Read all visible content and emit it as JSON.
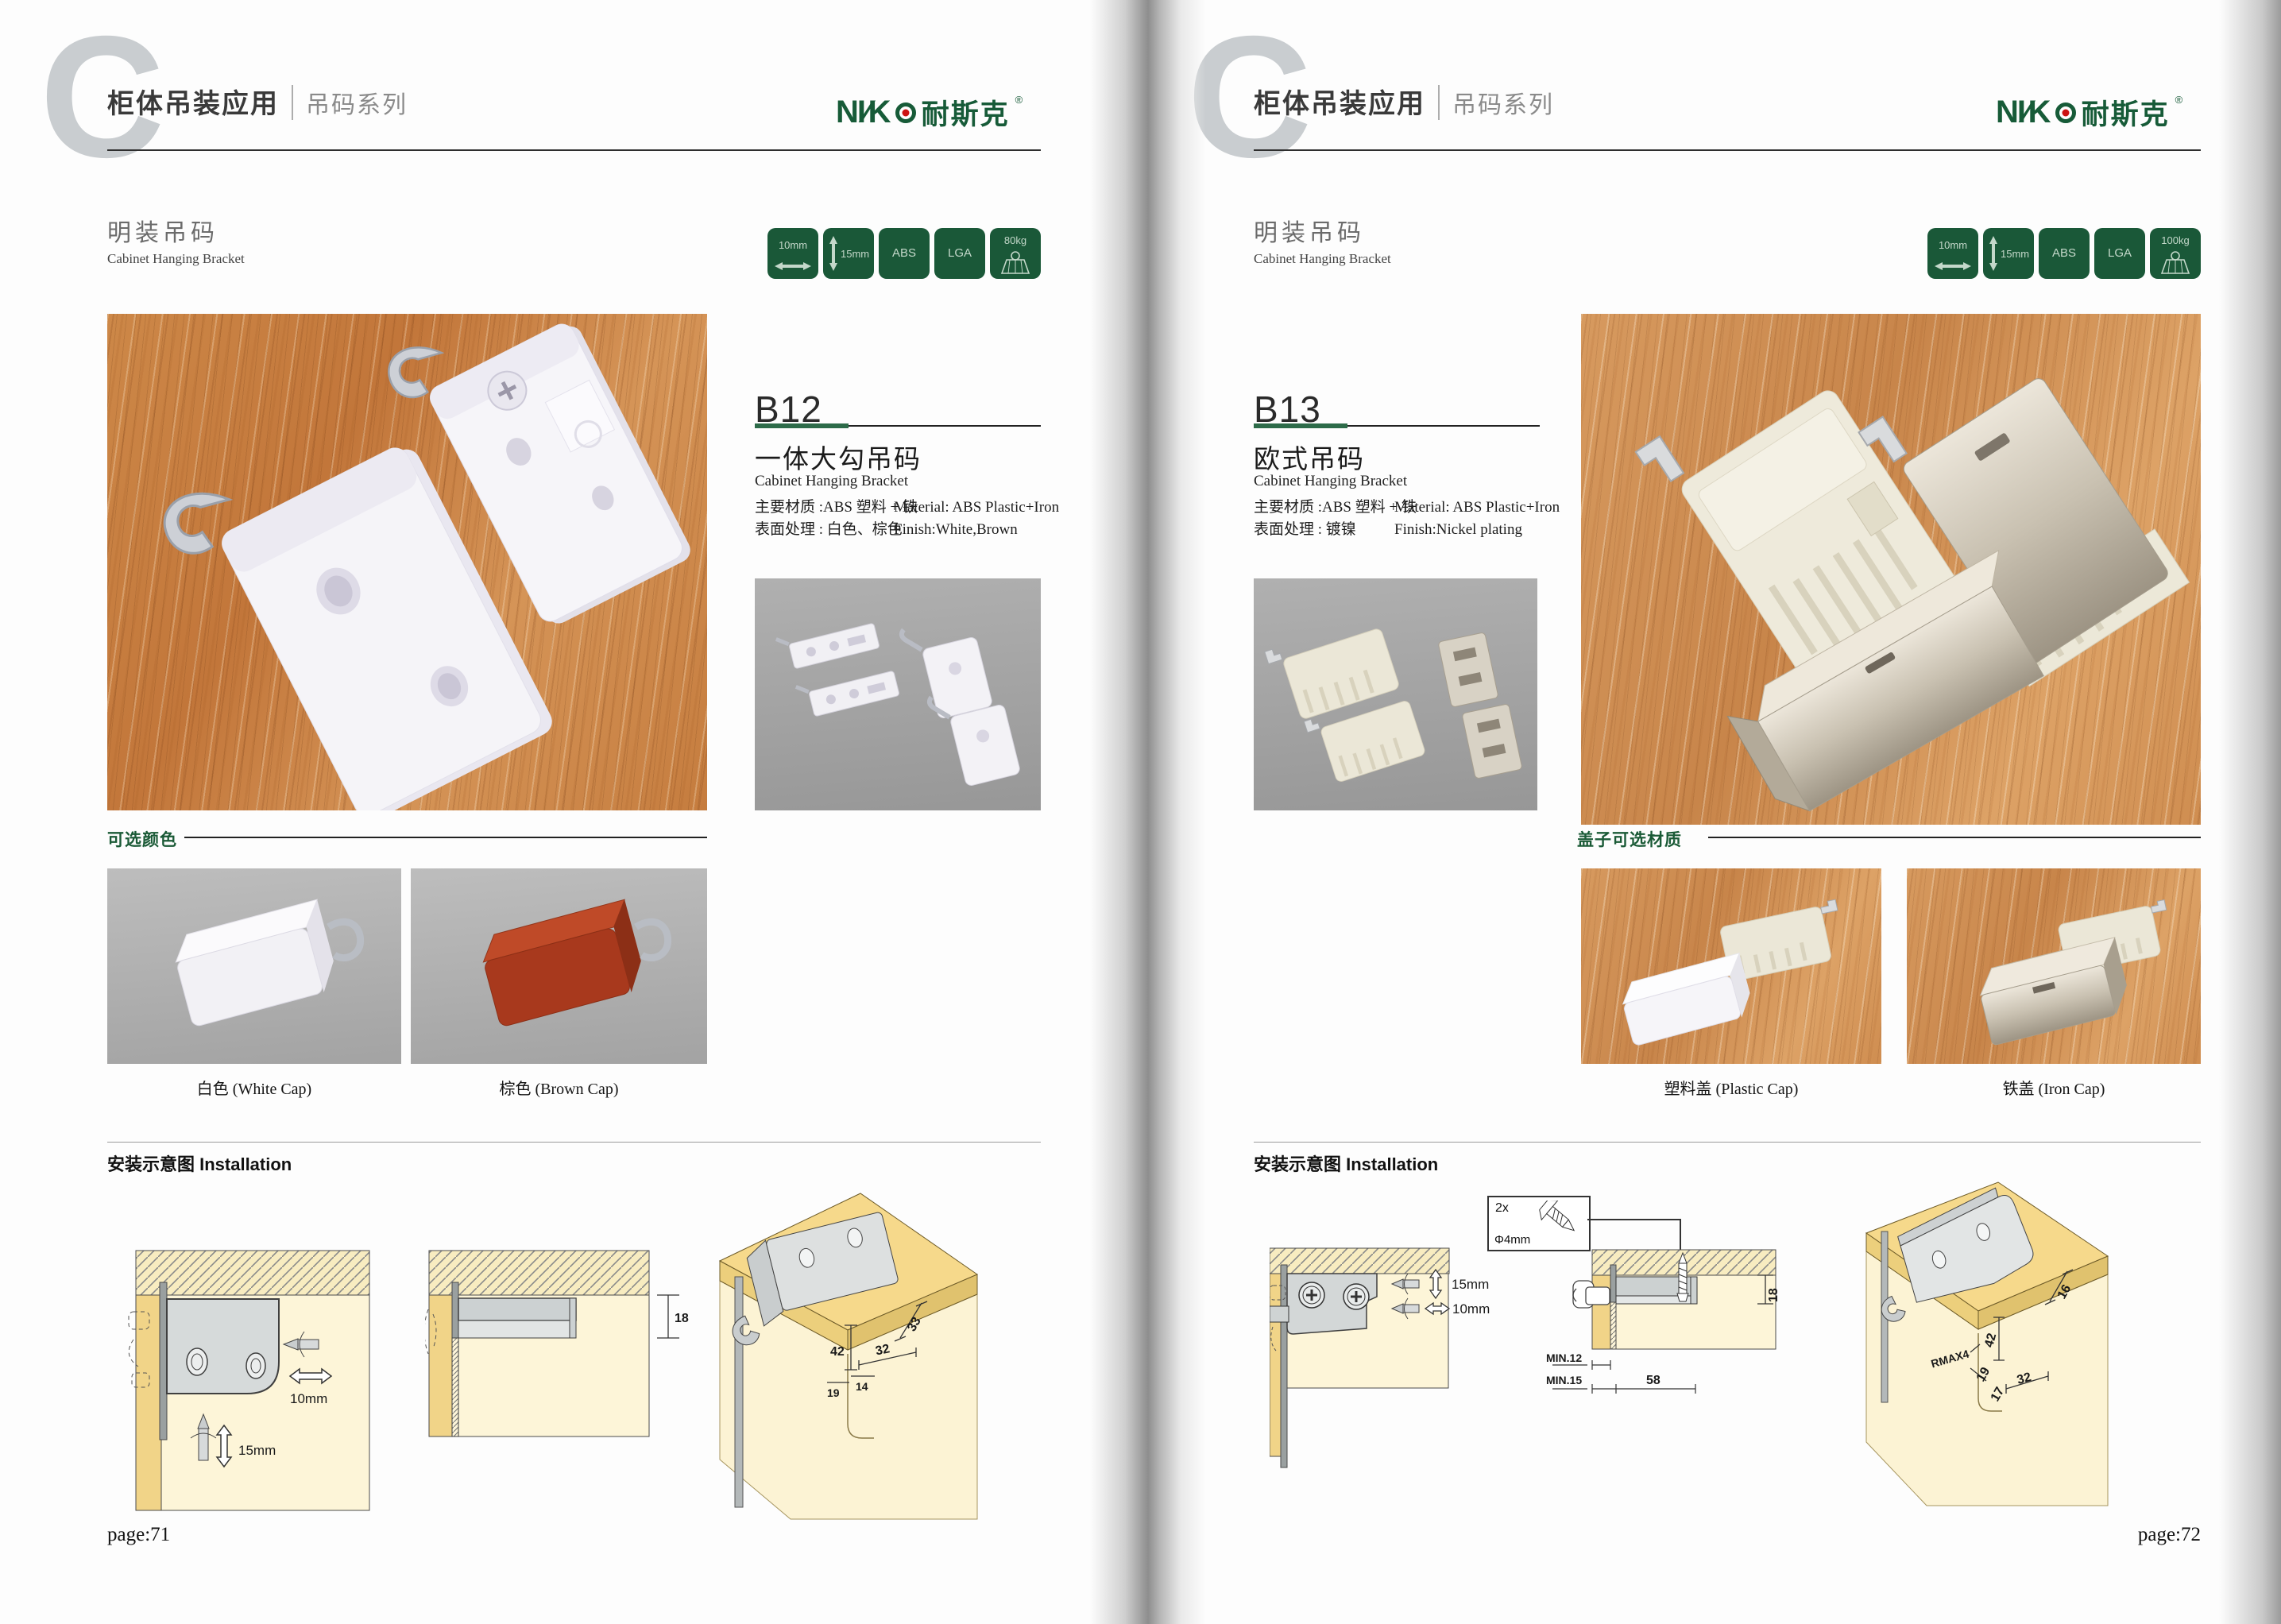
{
  "brand": {
    "logo_latin": "NI∕K",
    "logo_cn": "耐斯克",
    "logo_reg": "®"
  },
  "colors": {
    "brand_green": "#175b38",
    "badge_green": "#1a5838",
    "logo_red": "#cc1212"
  },
  "left": {
    "letter": "C",
    "header": {
      "title": "柜体吊装应用",
      "series": "吊码系列"
    },
    "section": {
      "title_cn": "明装吊码",
      "title_en": "Cabinet Hanging Bracket"
    },
    "badges": [
      {
        "label": "10mm",
        "icon": "width-arrow"
      },
      {
        "label": "15mm",
        "icon": "height-arrow"
      },
      {
        "label": "ABS",
        "icon": "none"
      },
      {
        "label": "LGA",
        "icon": "none"
      },
      {
        "label": "80kg",
        "icon": "load-capacity"
      }
    ],
    "product": {
      "code": "B12",
      "name_cn": "一体大勾吊码",
      "name_en": "Cabinet Hanging Bracket",
      "material_cn": "主要材质 :ABS 塑料 + 铁",
      "material_en": "Material: ABS Plastic+Iron",
      "finish_cn": "表面处理 : 白色、棕色",
      "finish_en": "Finish:White,Brown"
    },
    "options": {
      "title": "可选颜色",
      "captions": [
        "白色 (White Cap)",
        "棕色 (Brown Cap)"
      ]
    },
    "install": {
      "title": "安装示意图 Installation",
      "labels": {
        "d10": "10mm",
        "d15": "15mm",
        "d18": "18",
        "d33": "33",
        "d42": "42",
        "d32": "32",
        "d14": "14",
        "d19": "19"
      }
    },
    "page_label": "page:71"
  },
  "right": {
    "letter": "C",
    "header": {
      "title": "柜体吊装应用",
      "series": "吊码系列"
    },
    "section": {
      "title_cn": "明装吊码",
      "title_en": "Cabinet Hanging Bracket"
    },
    "badges": [
      {
        "label": "10mm",
        "icon": "width-arrow"
      },
      {
        "label": "15mm",
        "icon": "height-arrow"
      },
      {
        "label": "ABS",
        "icon": "none"
      },
      {
        "label": "LGA",
        "icon": "none"
      },
      {
        "label": "100kg",
        "icon": "load-capacity"
      }
    ],
    "product": {
      "code": "B13",
      "name_cn": "欧式吊码",
      "name_en": "Cabinet Hanging Bracket",
      "material_cn": "主要材质 :ABS 塑料 + 铁",
      "material_en": "Material: ABS Plastic+Iron",
      "finish_cn": "表面处理 : 镀镍",
      "finish_en": "Finish:Nickel plating"
    },
    "options": {
      "title": "盖子可选材质",
      "captions": [
        "塑料盖 (Plastic Cap)",
        "铁盖 (Iron Cap)"
      ]
    },
    "install": {
      "title": "安装示意图 Installation",
      "labels": {
        "qty": "2x",
        "dia": "Φ4mm",
        "d15": "15mm",
        "d10": "10mm",
        "d18": "18",
        "min12": "MIN.12",
        "min15": "MIN.15",
        "d58": "58",
        "d16": "16",
        "d42": "42",
        "rmax": "RMAX4",
        "d19": "19",
        "d17": "17",
        "d32": "32"
      }
    },
    "page_label": "page:72"
  }
}
